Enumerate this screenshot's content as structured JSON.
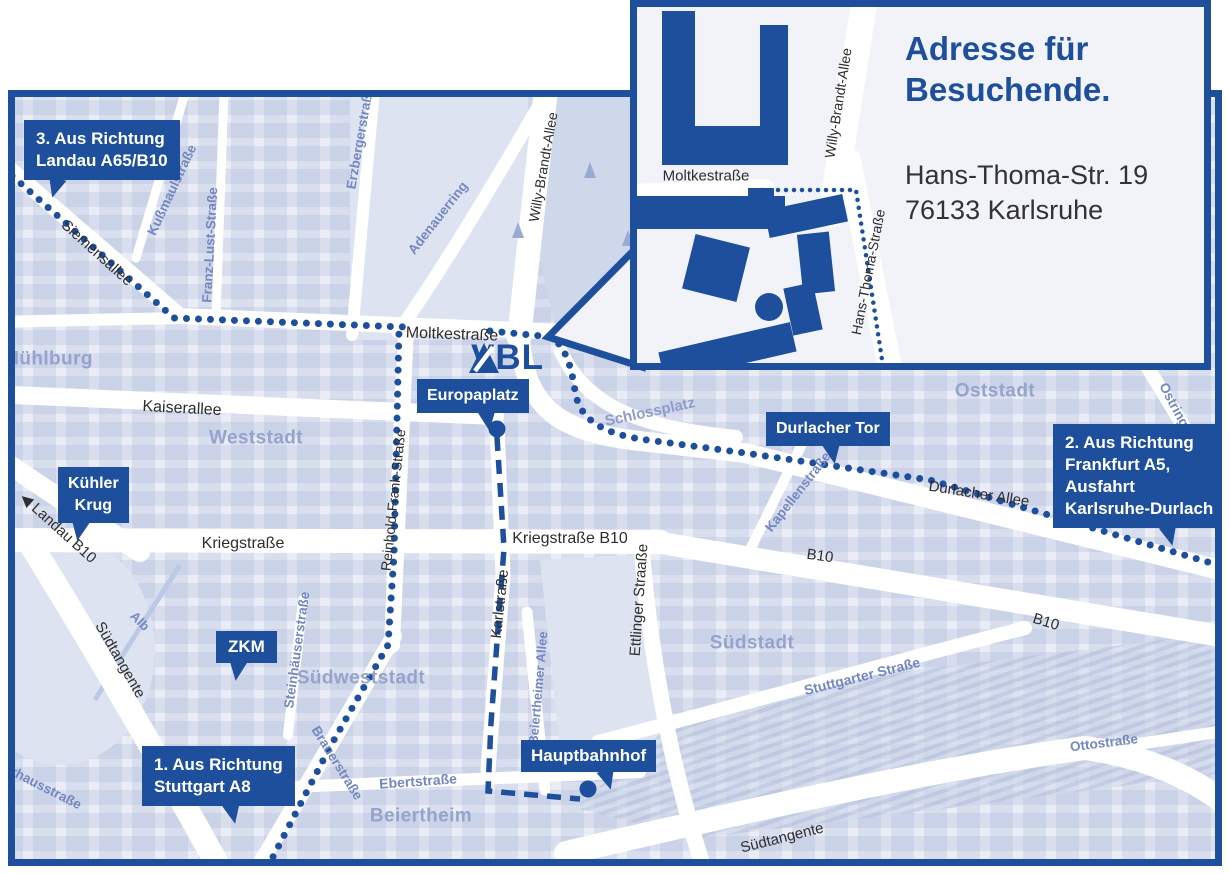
{
  "colors": {
    "brand_blue": "#1d4f9c",
    "map_bg": "#eaedf5",
    "panel_bg": "#f1f3f8",
    "park": "#cfd7ea",
    "district": "#95a3cd",
    "street_dark": "#2e2e2e",
    "street_blue": "#7487bf"
  },
  "inset": {
    "title_line1": "Adresse für",
    "title_line2": "Besuchende.",
    "address_line1": "Hans-Thoma-Str. 19",
    "address_line2": "76133 Karlsruhe",
    "street_moltkestrasse": "Moltkestraße",
    "street_willy_brandt_allee": "Willy-Brandt-Allee",
    "street_hans_thoma_strasse": "Hans-Thoma-Straße"
  },
  "logo": {
    "text": "VBL"
  },
  "icons": {
    "direction_arrow": "◀"
  },
  "callouts": {
    "route3_line1": "3. Aus Richtung",
    "route3_line2": "Landau A65/B10",
    "route2_line1": "2. Aus Richtung",
    "route2_line2": "Frankfurt A5,",
    "route2_line3": "Ausfahrt",
    "route2_line4": "Karlsruhe-Durlach",
    "route1_line1": "1. Aus Richtung",
    "route1_line2": "Stuttgart A8",
    "europaplatz": "Europaplatz",
    "durlacher_tor": "Durlacher Tor",
    "kuehler_krug_line1": "Kühler",
    "kuehler_krug_line2": "Krug",
    "zkm": "ZKM",
    "hauptbahnhof": "Hauptbahnhof"
  },
  "streets": {
    "siemensallee": "Siemensallee",
    "kussmaulstrasse": "Kußmaulstraße",
    "franz_lust_strasse": "Franz-Lust-Straße",
    "erzbergerstrasse": "Erzbergerstraße",
    "adenauerring": "Adenauerring",
    "willy_brandt_allee": "Willy-Brandt-Allee",
    "moltkestrasse": "Moltkestraße",
    "kaiserallee": "Kaiserallee",
    "reinhold_frank_strasse": "Reinhold-Frank-Straße",
    "kriegstrasse": "Kriegstraße",
    "kriegstrasse_b10": "Kriegstraße B10",
    "karlstrasse": "Karlstraße",
    "ettlinger_strasse": "Ettlinger Straaße",
    "beiertheimer_allee": "Beiertheimer Allee",
    "kapellenstrasse": "Kapellenstraße",
    "durlacher_allee": "Durlacher Allee",
    "b10_west": "B10",
    "b10_east": "B10",
    "landau_b10": "Landau B10",
    "suedtangente_left": "Südtangente",
    "suedtangente_right": "Südtangente",
    "steinhaeuserstrasse": "Steinhäuserstraße",
    "brauerstrasse": "Brauerstraße",
    "ebertstrasse": "Ebertstraße",
    "stuttgarter_strasse": "Stuttgarter Straße",
    "ottostrasse": "Ottostraße",
    "ostring": "Ostring",
    "pulverhausstrasse": "Pulverhausstraße",
    "alb": "Alb"
  },
  "districts": {
    "muehlburg": "Mühlburg",
    "weststadt": "Weststadt",
    "oststadt": "Oststadt",
    "suedstadt": "Südstadt",
    "suedweststadt": "Südweststadt",
    "beiertheim": "Beiertheim",
    "schlossplatz": "Schlossplatz"
  }
}
